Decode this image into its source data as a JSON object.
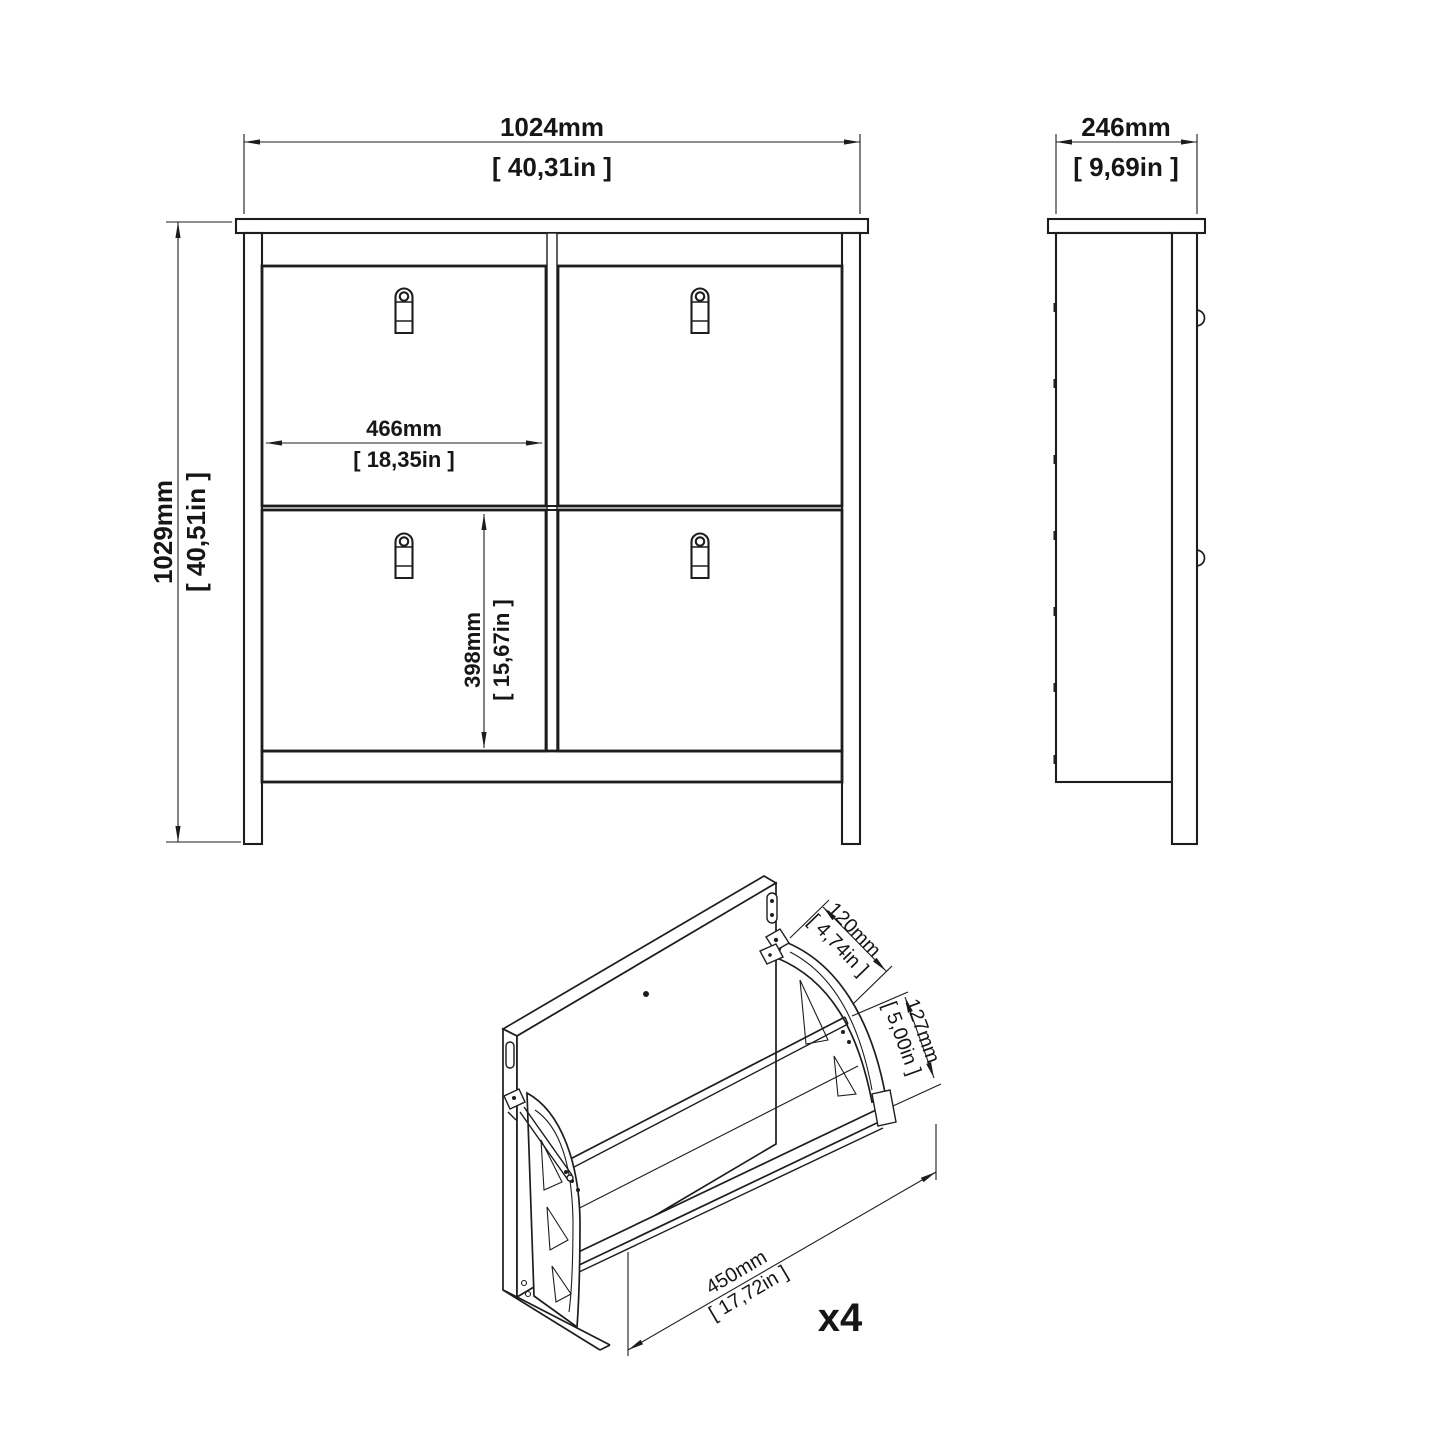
{
  "front_view": {
    "width": {
      "metric": "1024mm",
      "imperial": "[ 40,31in ]"
    },
    "height": {
      "metric": "1029mm",
      "imperial": "[ 40,51in ]"
    },
    "compartment_width": {
      "metric": "466mm",
      "imperial": "[ 18,35in ]"
    },
    "compartment_height": {
      "metric": "398mm",
      "imperial": "[ 15,67in ]"
    }
  },
  "side_view": {
    "depth": {
      "metric": "246mm",
      "imperial": "[ 9,69in ]"
    }
  },
  "flap_detail": {
    "flap_depth": {
      "metric": "120mm",
      "imperial": "[ 4,74in ]"
    },
    "flap_height": {
      "metric": "127mm",
      "imperial": "[ 5,00in ]"
    },
    "flap_width": {
      "metric": "450mm",
      "imperial": "[ 17,72in ]"
    },
    "quantity": "x4"
  },
  "colors": {
    "line": "#1d1d1b",
    "background": "#ffffff"
  }
}
